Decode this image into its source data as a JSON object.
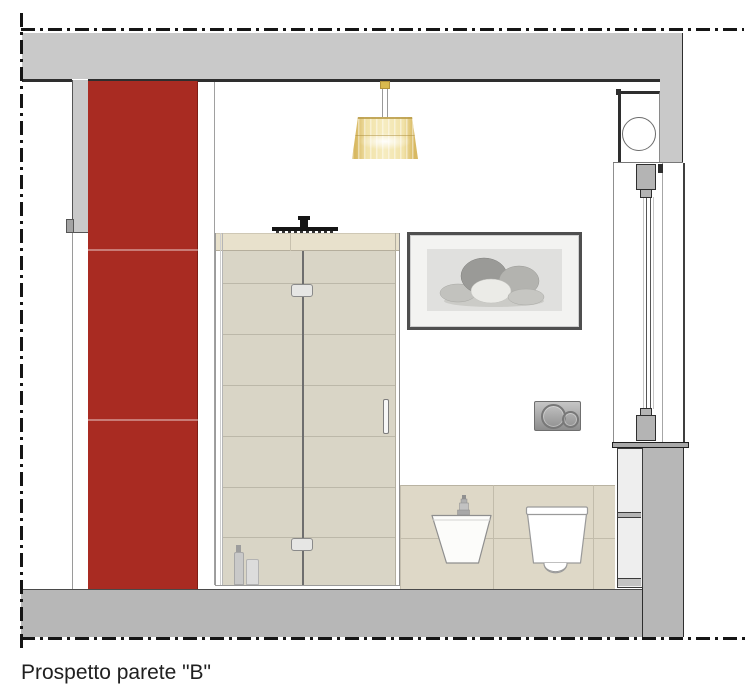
{
  "caption": "Prospetto parete \"B\"",
  "colors": {
    "accent-red": "#a92b22",
    "wall-gray": "#c9c9c9",
    "floor-gray": "#b7b7b7",
    "tile-beige": "#d9d5c6",
    "band-beige": "#e8e1cc",
    "wainscot-beige": "#ded8c7",
    "lamp-yellow": "#eed584",
    "line-dark": "#1f1f1f"
  }
}
